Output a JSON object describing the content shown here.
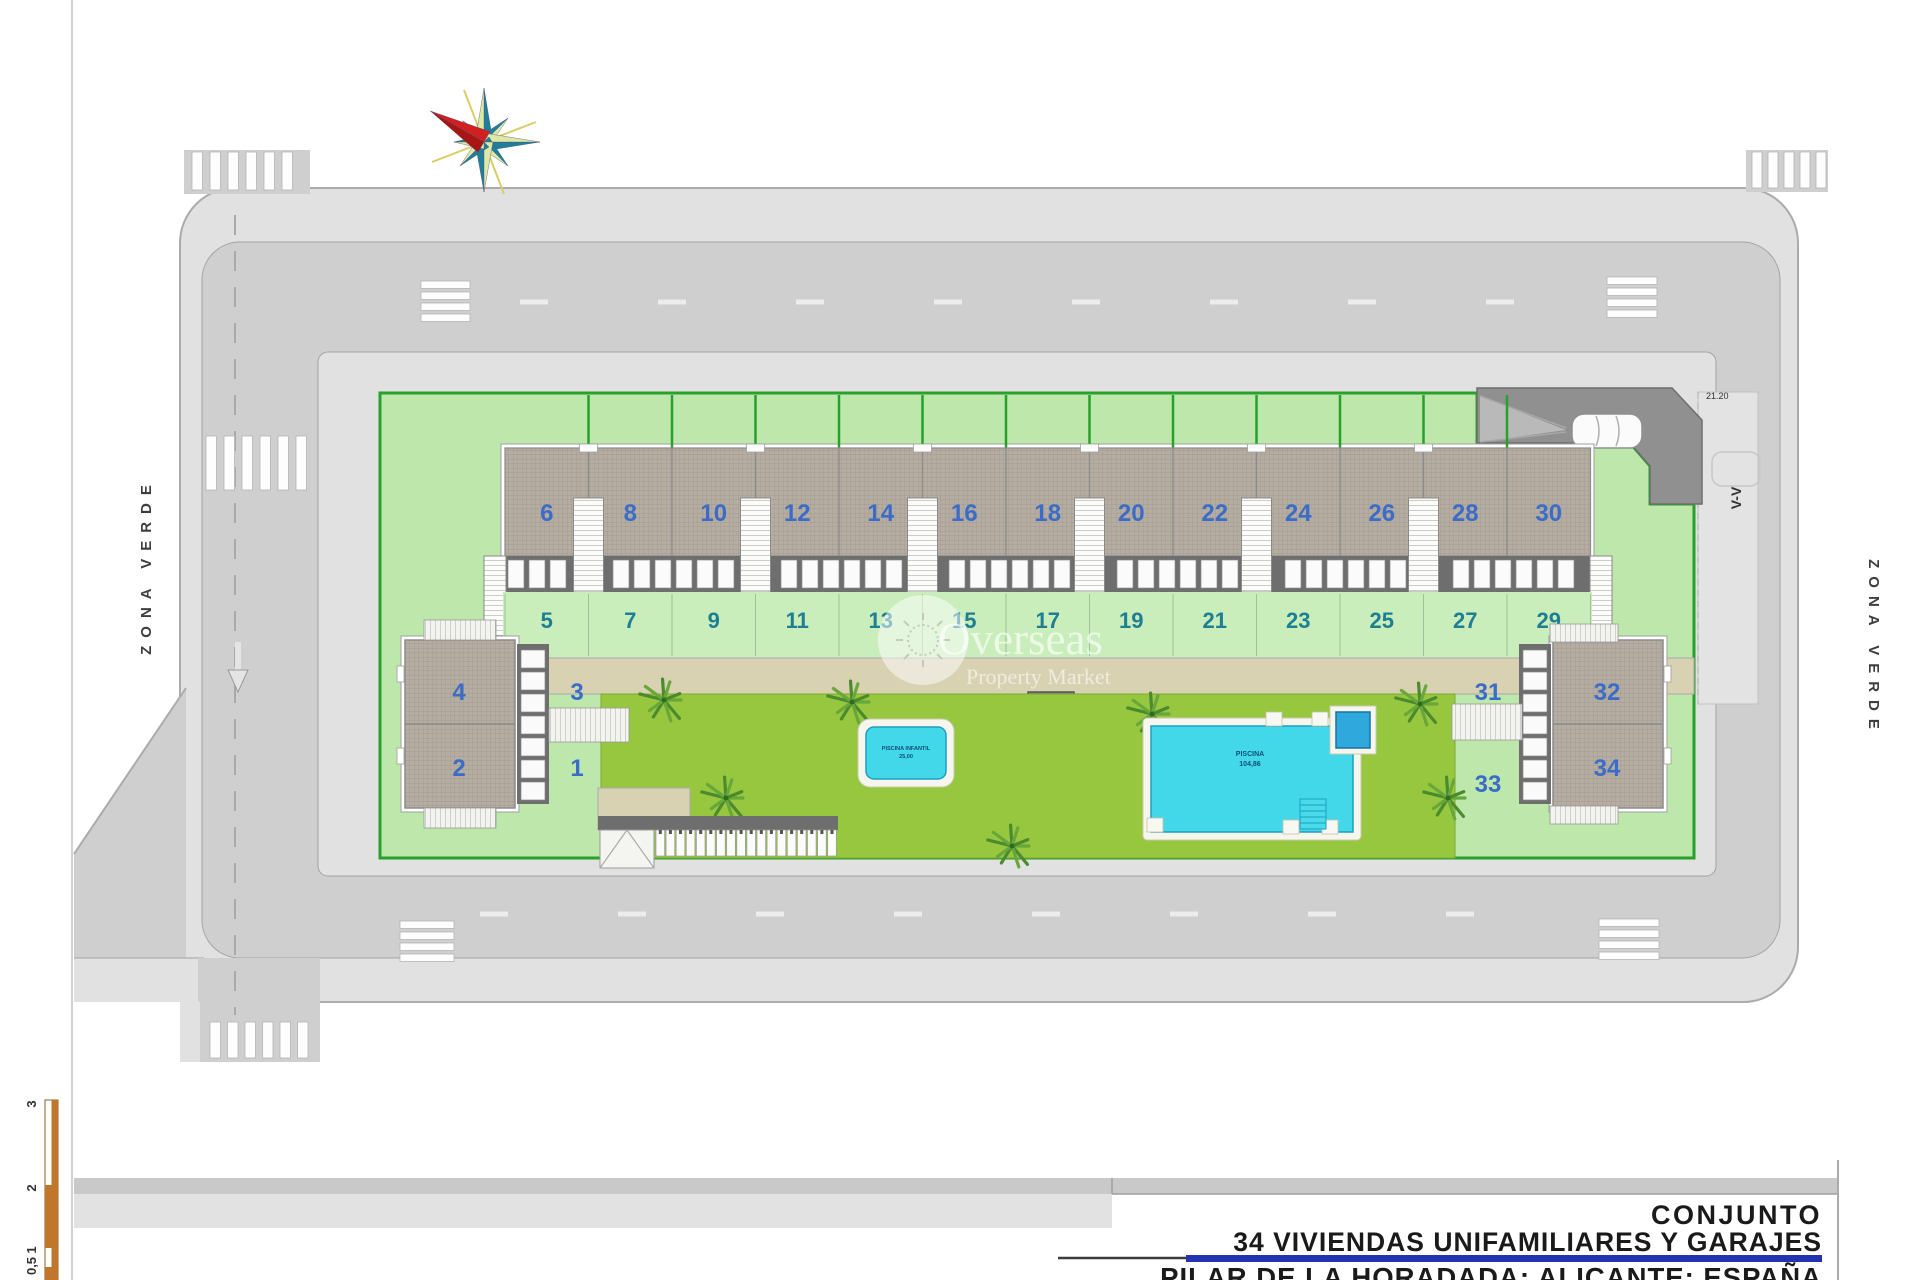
{
  "drawing": {
    "title_block": {
      "project": "CONJUNTO",
      "subtitle": "34 VIVIENDAS UNIFAMILIARES Y GARAJES",
      "location": "PILAR DE LA HORADADA; ALICANTE; ESPAÑA"
    },
    "zona_verde_left": "ZONA VERDE",
    "zona_verde_right": "ZONA VERDE",
    "section_label": "V-V",
    "driveway_dimension": "21.20",
    "watermark": {
      "name": "Overseas",
      "tagline": "Property Market",
      "icon": "sun-logo-icon"
    },
    "pools": {
      "small_label": "PISCINA INFANTIL",
      "small_area": "25,00",
      "large_label": "PISCINA",
      "large_area": "104,86"
    },
    "row_houses": {
      "upper": [
        "6",
        "8",
        "10",
        "12",
        "14",
        "16",
        "18",
        "20",
        "22",
        "24",
        "26",
        "28",
        "30"
      ],
      "lower": [
        "5",
        "7",
        "9",
        "11",
        "13",
        "15",
        "17",
        "19",
        "21",
        "23",
        "25",
        "27",
        "29"
      ]
    },
    "left_building": {
      "roof_upper": "4",
      "roof_lower": "2",
      "plot_upper": "3",
      "plot_lower": "1"
    },
    "right_building": {
      "roof_upper": "32",
      "roof_lower": "34",
      "plot_upper": "31",
      "plot_lower": "33"
    },
    "scale_bar": {
      "ticks": [
        "3",
        "2",
        "1",
        "0,5"
      ]
    },
    "colors": {
      "site_green": "#BEE8AB",
      "border_green": "#27A02C",
      "garden_green": "#96C73F",
      "plot_green": "#C9EDBB",
      "pool_cyan": "#42D8EA",
      "pool_edge": "#1D9FC0",
      "road_gray": "#CFCFCF",
      "sidewalk_gray": "#E1E1E1",
      "tan_path": "#D8D1B2",
      "accent_blue": "#2433B0",
      "number_blue": "#3A6CC8",
      "number_teal": "#1E7E92",
      "scale_orange": "#C0772B",
      "roof_gray": "#B5ACA2"
    }
  }
}
